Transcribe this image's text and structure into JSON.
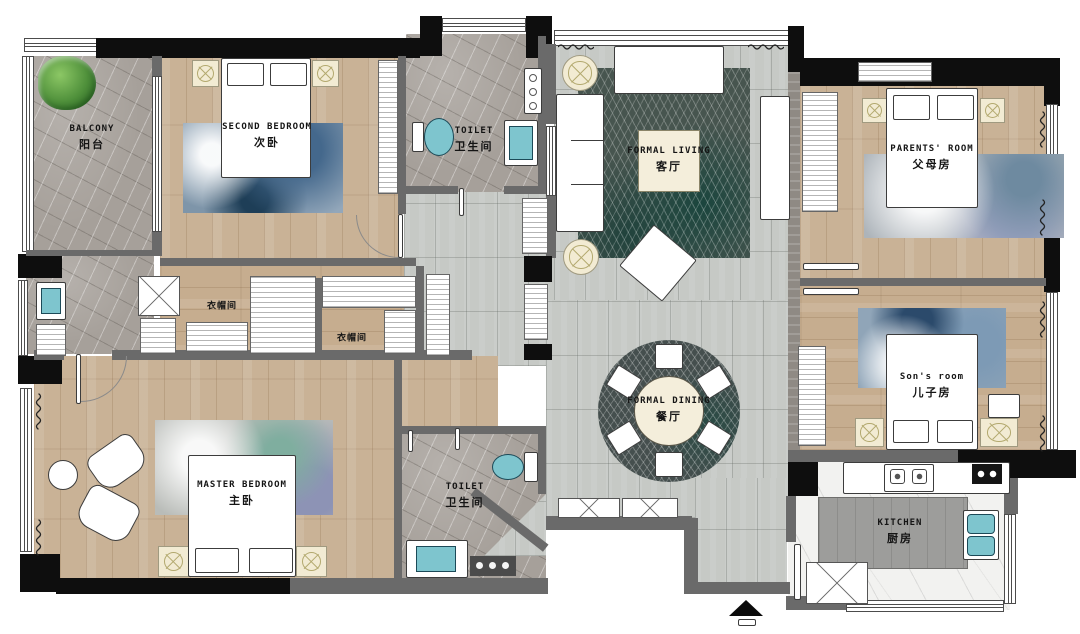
{
  "rooms": {
    "balcony": {
      "en": "BALCONY",
      "zh": "阳台"
    },
    "second_bedroom": {
      "en": "SECOND BEDROOM",
      "zh": "次卧"
    },
    "toilet_upper": {
      "en": "TOILET",
      "zh": "卫生间"
    },
    "formal_living": {
      "en": "FORMAL LIVING",
      "zh": "客厅"
    },
    "parents_room": {
      "en": "PARENTS' ROOM",
      "zh": "父母房"
    },
    "cloakroom_left": {
      "zh": "衣帽间"
    },
    "cloakroom_right": {
      "zh": "衣帽间"
    },
    "master_bedroom": {
      "en": "MASTER BEDROOM",
      "zh": "主卧"
    },
    "toilet_lower": {
      "en": "TOILET",
      "zh": "卫生间"
    },
    "formal_dining": {
      "en": "FORMAL DINING",
      "zh": "餐厅"
    },
    "sons_room": {
      "en": "Son's room",
      "zh": "儿子房"
    },
    "kitchen": {
      "en": "KITCHEN",
      "zh": "厨房"
    }
  },
  "colors": {
    "wood_floor": "#c9b296",
    "marble_floor": "#a6a09a",
    "tile_floor": "#c6c9c5",
    "kitchen_floor": "#f2f2f0",
    "wall": "#6a6a6a",
    "column": "#0e0e0e",
    "fixture_teal": "#7ec5ce",
    "rug_dark_teal": "#47554f",
    "furniture_cream": "#f2ebd3",
    "plant_green": "#4e8f3a"
  }
}
